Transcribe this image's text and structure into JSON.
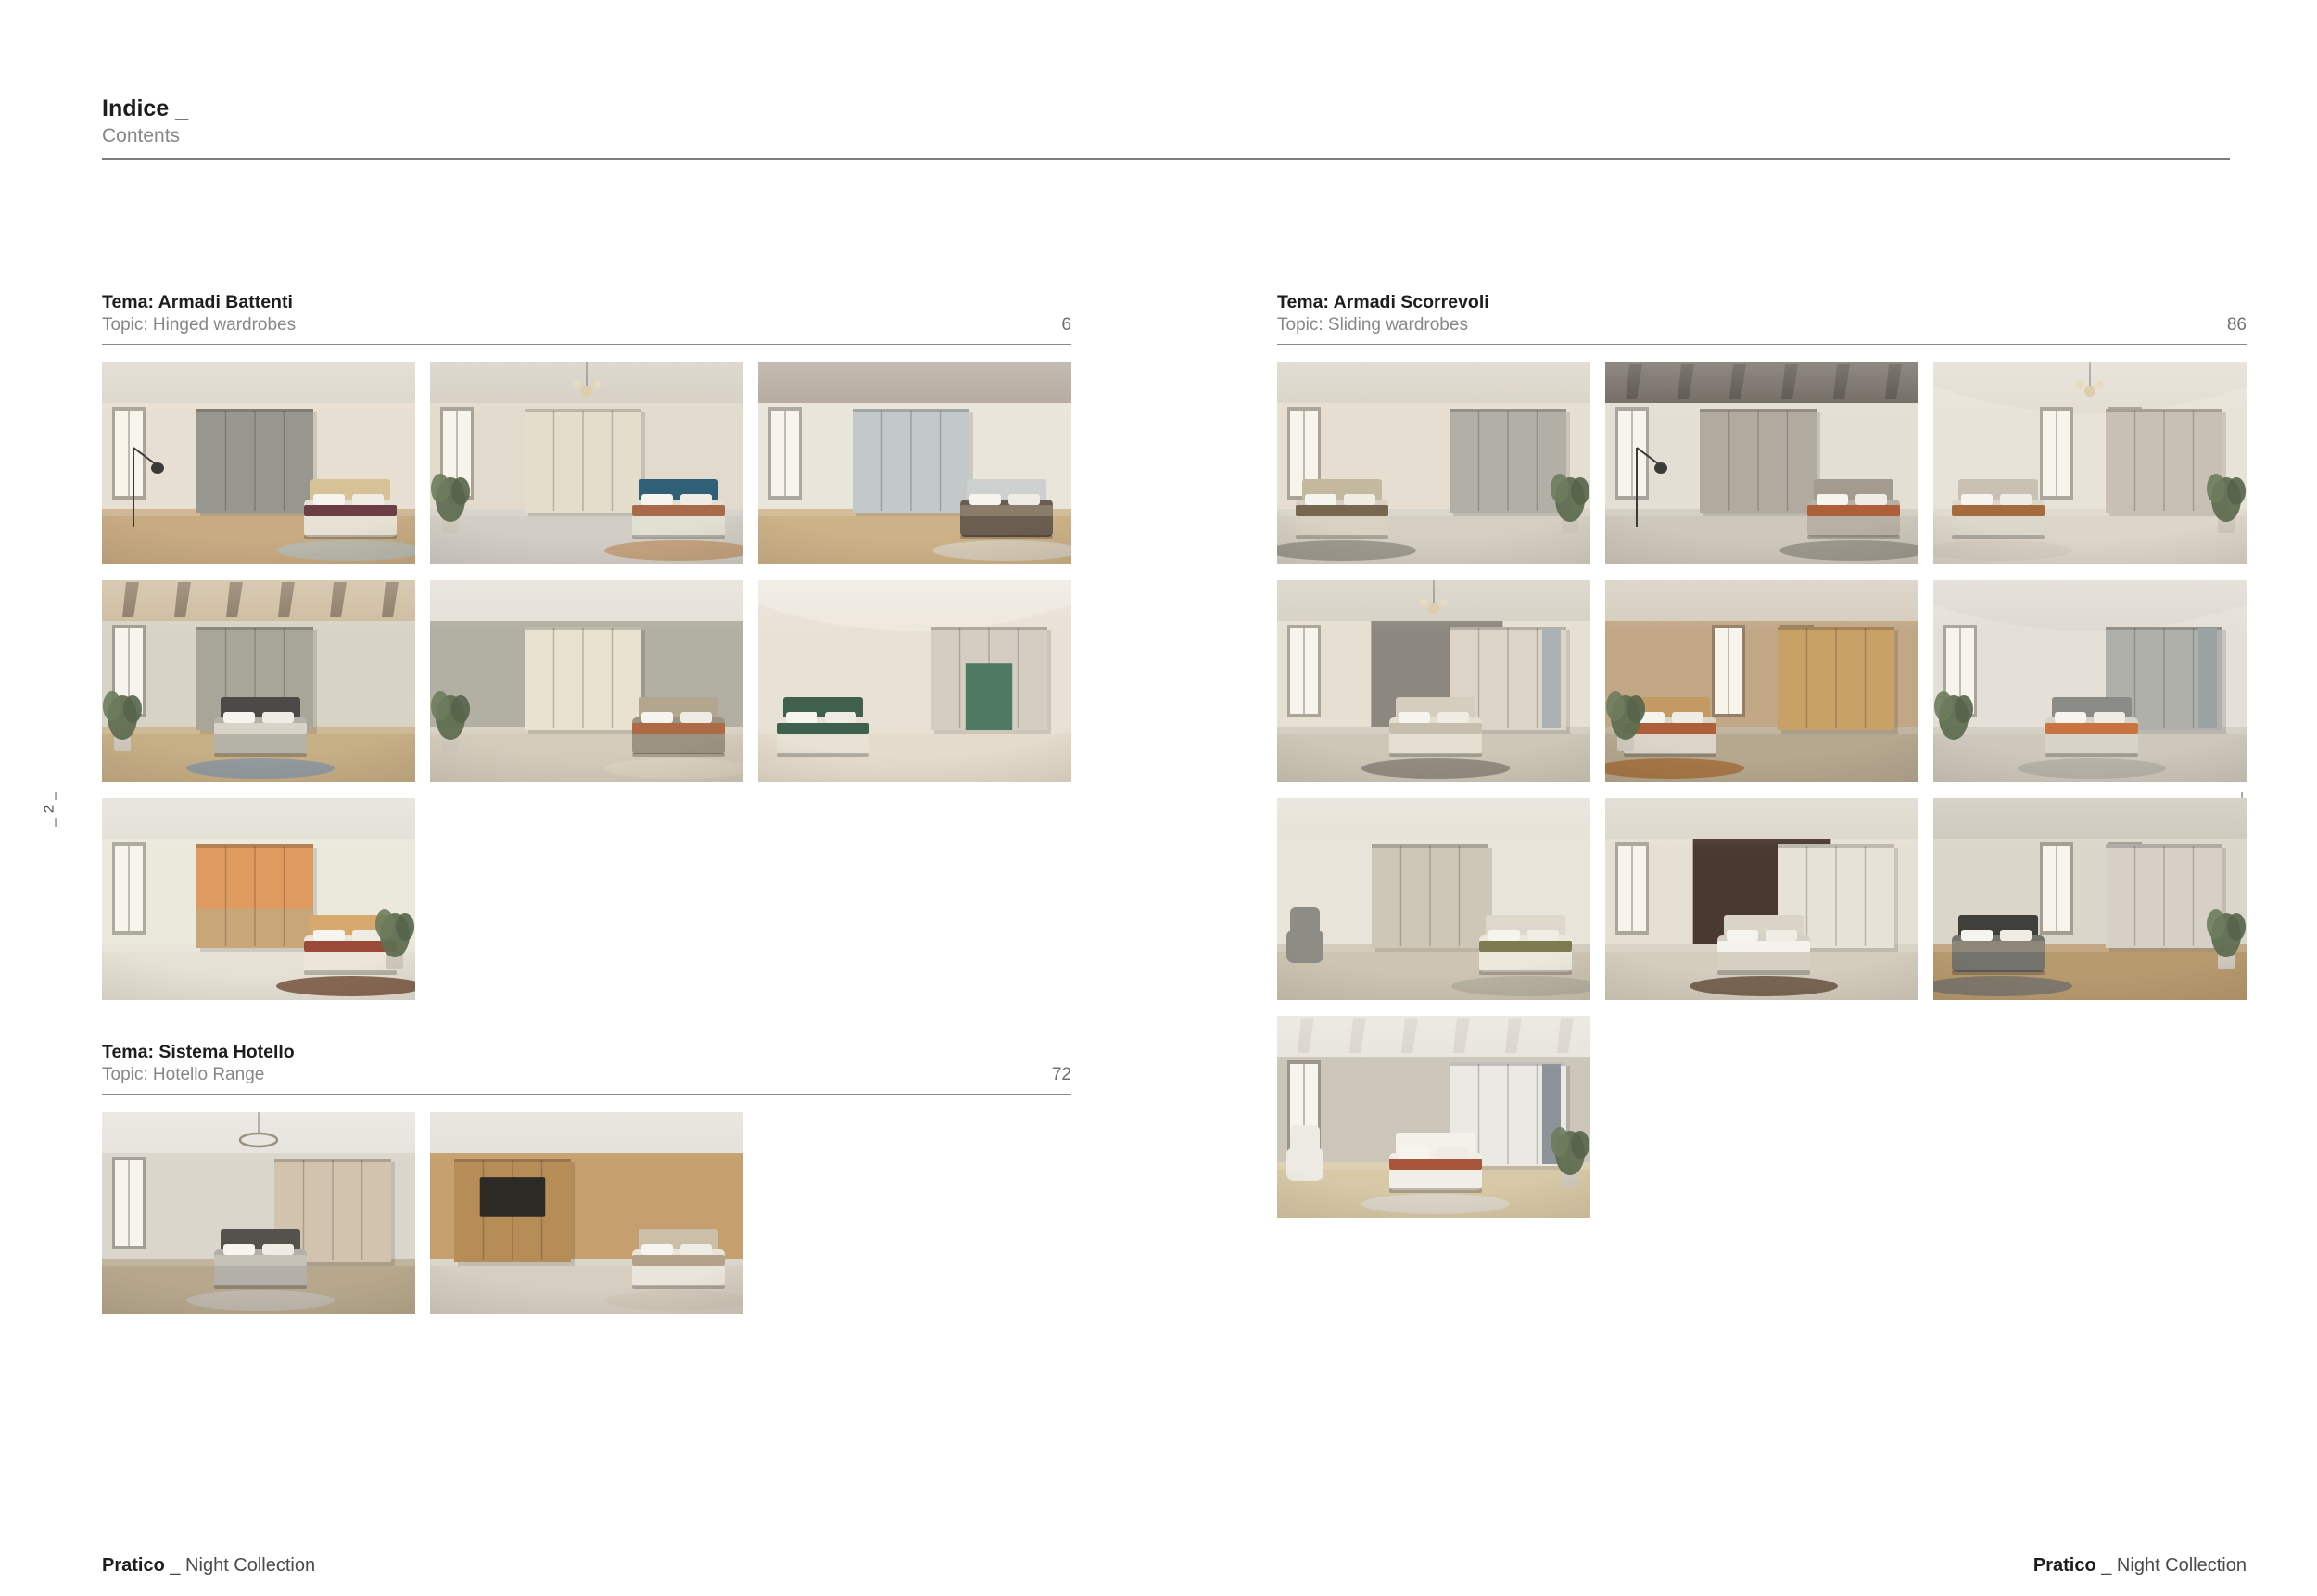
{
  "page": {
    "background": "#ffffff",
    "header": {
      "title": "Indice",
      "title_suffix": "_",
      "subtitle": "Contents"
    },
    "side_markers": {
      "left": "_ 2 _",
      "right": "_ 3 _"
    },
    "footer_left": {
      "brand": "Pratico",
      "rest": "_ Night Collection"
    },
    "footer_right": {
      "brand": "Pratico",
      "rest": "_ Night Collection"
    },
    "colors": {
      "ink": "#1d1d1b",
      "muted": "#878787",
      "rule": "#7d7d7d"
    }
  },
  "sections": [
    {
      "title": "Tema: Armadi Battenti",
      "subtitle": "Topic: Hinged wardrobes",
      "page_number": "6",
      "thumbnails": [
        {
          "desc": "grey hinged wardrobe bedroom, bed with burgundy throw, black floor lamp",
          "wall": "#e7e0d2",
          "ceiling": "#dcd7cb",
          "floor": "#c8ab83",
          "ward": "#97968f",
          "wardSide": "c",
          "bed": "#e6e1d4",
          "head": "#d7c197",
          "bedSide": "r",
          "accent": "#6d3d46",
          "rug": "#b7bbb1",
          "win": "l",
          "lamp": "floor"
        },
        {
          "desc": "cream wardrobe with tv niche, blue headboard bed, chandelier, plant",
          "wall": "#e2dbcd",
          "ceiling": "#d5cfc3",
          "floor": "#d2cec5",
          "ward": "#e4ddcb",
          "wardSide": "c",
          "bed": "#dfe0d2",
          "head": "#2f6077",
          "bedSide": "r",
          "accent": "#a96a4c",
          "rug": "#c29e77",
          "win": "l",
          "plant": "l",
          "lamp": "pendant"
        },
        {
          "desc": "pale grey-blue wardrobe, led cove ceiling, macrame wall hanging",
          "wall": "#eae5db",
          "ceiling": "#b3a89c",
          "floor": "#cdb288",
          "ward": "#c2c9c8",
          "wardSide": "c",
          "bed": "#6a5e51",
          "head": "#ccd1cf",
          "bedSide": "r",
          "accent": "#8a7c6a",
          "rug": "#d6cdbd",
          "win": "l"
        },
        {
          "desc": "bridge wardrobe over dark bed, timber beam ceiling, tall window",
          "wall": "#d7d4c6",
          "ceiling": "#cdbb9e",
          "beams": true,
          "beam": "#8a7a62",
          "floor": "#c6ae85",
          "ward": "#a7a698",
          "wardSide": "c",
          "bed": "#b5b2a8",
          "head": "#4b4a47",
          "bedSide": "c",
          "accent": "#d7d3c7",
          "rug": "#8c98a1",
          "win": "l",
          "plant": "l"
        },
        {
          "desc": "tall cream hinged wardrobe, greige bed with rust throw, plant",
          "wall": "#b2afa3",
          "ceiling": "#e4e0d6",
          "floor": "#d4cbbb",
          "ward": "#e9e2cf",
          "wardSide": "c",
          "bed": "#9b9282",
          "head": "#b3a68e",
          "bedSide": "r",
          "accent": "#ad6a45",
          "rug": "#dcd3c2",
          "plant": "l"
        },
        {
          "desc": "vaulted room, wardrobe with green desk niche and shelving, green bed",
          "wall": "#e8e1d6",
          "vault": true,
          "ceiling": "#eee8de",
          "floor": "#e4dbcc",
          "ward": "#d6cdc2",
          "wardSide": "r",
          "niche": "#4e7a63",
          "bed": "#e7e2d4",
          "head": "#3e604c",
          "bedSide": "l",
          "accent": "#3e604c",
          "rug": "#e6ddcd"
        },
        {
          "desc": "orange and oak two-tone wardrobe, desk, round brown rugs, plant",
          "wall": "#ebe8dc",
          "ceiling": "#e2dfd5",
          "floor": "#e6e1d5",
          "ward": "#df9a5f",
          "base": "#c8a678",
          "wardSide": "c",
          "bed": "#ece6da",
          "head": "#d8a96c",
          "bedSide": "r",
          "accent": "#994a39",
          "rug": "#7c5c46",
          "win": "l",
          "plant": "r"
        }
      ]
    },
    {
      "title": "Tema: Sistema Hotello",
      "subtitle": "Topic: Hotello Range",
      "page_number": "72",
      "thumbnails": [
        {
          "desc": "hotel room, ring chandelier, panelled wall, grey bed, wardrobe right",
          "wall": "#dad6cc",
          "ceiling": "#e6e3dc",
          "floor": "#b7a88d",
          "ward": "#d2c3ae",
          "wardSide": "r",
          "bed": "#b2b0a8",
          "head": "#55524d",
          "bedSide": "c",
          "accent": "#c6c2b8",
          "rug": "#c0bab0",
          "win": "l",
          "lamp": "ring"
        },
        {
          "desc": "hotel room, oak tv wall with desk, twin beds with white linen",
          "wall": "#c59f6d",
          "ceiling": "#e3e0d8",
          "floor": "#d6cec0",
          "ward": "#b78d57",
          "wardSide": "l",
          "tv": true,
          "bed": "#e9e5da",
          "head": "#cbbfa8",
          "bedSide": "r",
          "accent": "#b3a289",
          "rug": "#d2c9ba"
        }
      ]
    },
    {
      "title": "Tema: Armadi Scorrevoli",
      "subtitle": "Topic: Sliding wardrobes",
      "page_number": "86",
      "thumbnails": [
        {
          "desc": "tall windows, oak dresser, bed with brown throw, plant right",
          "wall": "#e6ded0",
          "ceiling": "#dad4c7",
          "floor": "#d5cfc3",
          "ward": "#b2afa6",
          "wardSide": "r",
          "bed": "#d9d2c2",
          "head": "#c4b89e",
          "bedSide": "l",
          "accent": "#77674f",
          "rug": "#98938a",
          "win": "l",
          "plant": "r"
        },
        {
          "desc": "dark beamed attic, grey sliding wardrobe, bed with rust throw",
          "wall": "#e3dfd4",
          "ceiling": "#6f685f",
          "beams": true,
          "beam": "#57514a",
          "floor": "#cec8bc",
          "ward": "#b1aa9f",
          "wardSide": "c",
          "bed": "#b7b1a4",
          "head": "#a39c8e",
          "bedSide": "r",
          "accent": "#ad5f3a",
          "rug": "#98938a",
          "win": "l",
          "lamp": "floor"
        },
        {
          "desc": "vaulted room, two curtained windows, oval mirror, chandelier, round rug",
          "wall": "#e8e3d9",
          "vault": true,
          "ceiling": "#e3ddd2",
          "floor": "#dcd5c8",
          "ward": "#c7c0b3",
          "wardSide": "r",
          "bed": "#dcd7cb",
          "head": "#c9c2b2",
          "bedSide": "l",
          "accent": "#a66a3f",
          "rug": "#d6cec0",
          "win": "2",
          "plant": "r",
          "lamp": "pendant"
        },
        {
          "desc": "mirror-strip sliding wardrobe, cream bed, sputnik chandelier",
          "wall": "#e6e0d2",
          "far": "#8d887f",
          "farX": 0.3,
          "farW": 0.42,
          "ceiling": "#d6d0c4",
          "floor": "#cdc7b8",
          "ward": "#dcd5c7",
          "wardSide": "r",
          "mirror": "#aab2b3",
          "bed": "#e4ded0",
          "head": "#d5cebf",
          "bedSide": "c",
          "accent": "#c6bfae",
          "rug": "#8c857b",
          "win": "l",
          "lamp": "pendant"
        },
        {
          "desc": "warm oak wardrobe wall with mirror niche, striped rug, tall plant",
          "wall": "#c2a787",
          "ceiling": "#d5ccbd",
          "floor": "#b6a88f",
          "ward": "#c7a166",
          "wardSide": "r",
          "bed": "#dcd5c7",
          "head": "#c29a62",
          "bedSide": "l",
          "accent": "#ad5f3a",
          "rug": "#a5713f",
          "win": "2",
          "plant": "l"
        },
        {
          "desc": "vaulted room, curved grey headboard bed, mirror wardrobe, hanging plants",
          "wall": "#e4e0d7",
          "vault": true,
          "ceiling": "#dedad1",
          "floor": "#cec8bc",
          "ward": "#b0b0aa",
          "wardSide": "r",
          "mirror": "#9aa2a3",
          "bed": "#d8d3c8",
          "head": "#8b8b87",
          "bedSide": "c",
          "accent": "#c9743f",
          "rug": "#b6b0a5",
          "win": "l",
          "plant": "l"
        },
        {
          "desc": "two-tone sliding wardrobe, grey armchair, bed with olive throw",
          "wall": "#e9e4d9",
          "ceiling": "#e6e1d6",
          "floor": "#cdc4b2",
          "ward": "#cec7b8",
          "wardSide": "c",
          "bed": "#ece7db",
          "head": "#ded8ca",
          "bedSide": "r",
          "accent": "#7c7b52",
          "rug": "#b6b0a0",
          "chair": "#8d8d85"
        },
        {
          "desc": "dark walnut feature wall, white bed, white wardrobe, round brown rug",
          "wall": "#e6e0d4",
          "far": "#4a392f",
          "farX": 0.28,
          "farW": 0.44,
          "ceiling": "#dcd7cb",
          "floor": "#d4cdbe",
          "ward": "#e7e2d7",
          "wardSide": "r",
          "bed": "#d6d0c2",
          "head": "#dad4c6",
          "bedSide": "c",
          "accent": "#f4f2ec",
          "rug": "#6e5a47",
          "win": "l"
        },
        {
          "desc": "floor-to-ceiling windows, charcoal bed, glossy sliding wardrobe, plant",
          "wall": "#dbd6ca",
          "ceiling": "#cdc7bb",
          "floor": "#b89a6f",
          "ward": "#d6d0c7",
          "wardSide": "r",
          "bed": "#74746e",
          "head": "#3f3f3c",
          "bedSide": "l",
          "accent": "#8c8779",
          "rug": "#7b776c",
          "win": "2",
          "plant": "r"
        },
        {
          "desc": "white sliding wardrobe with smoked glass, white bed with rust blanket, beams",
          "wall": "#ccc6ba",
          "ceiling": "#e7e4dc",
          "beams": true,
          "beam": "#d8d4ca",
          "floor": "#d7c8a6",
          "ward": "#ebe9e3",
          "wardSide": "r",
          "mirror": "#8d9499",
          "bed": "#f1eee7",
          "head": "#f4f1ea",
          "bedSide": "c",
          "accent": "#a7563b",
          "rug": "#dcd7cb",
          "win": "l",
          "plant": "r",
          "chair": "#eceae3"
        }
      ]
    }
  ]
}
